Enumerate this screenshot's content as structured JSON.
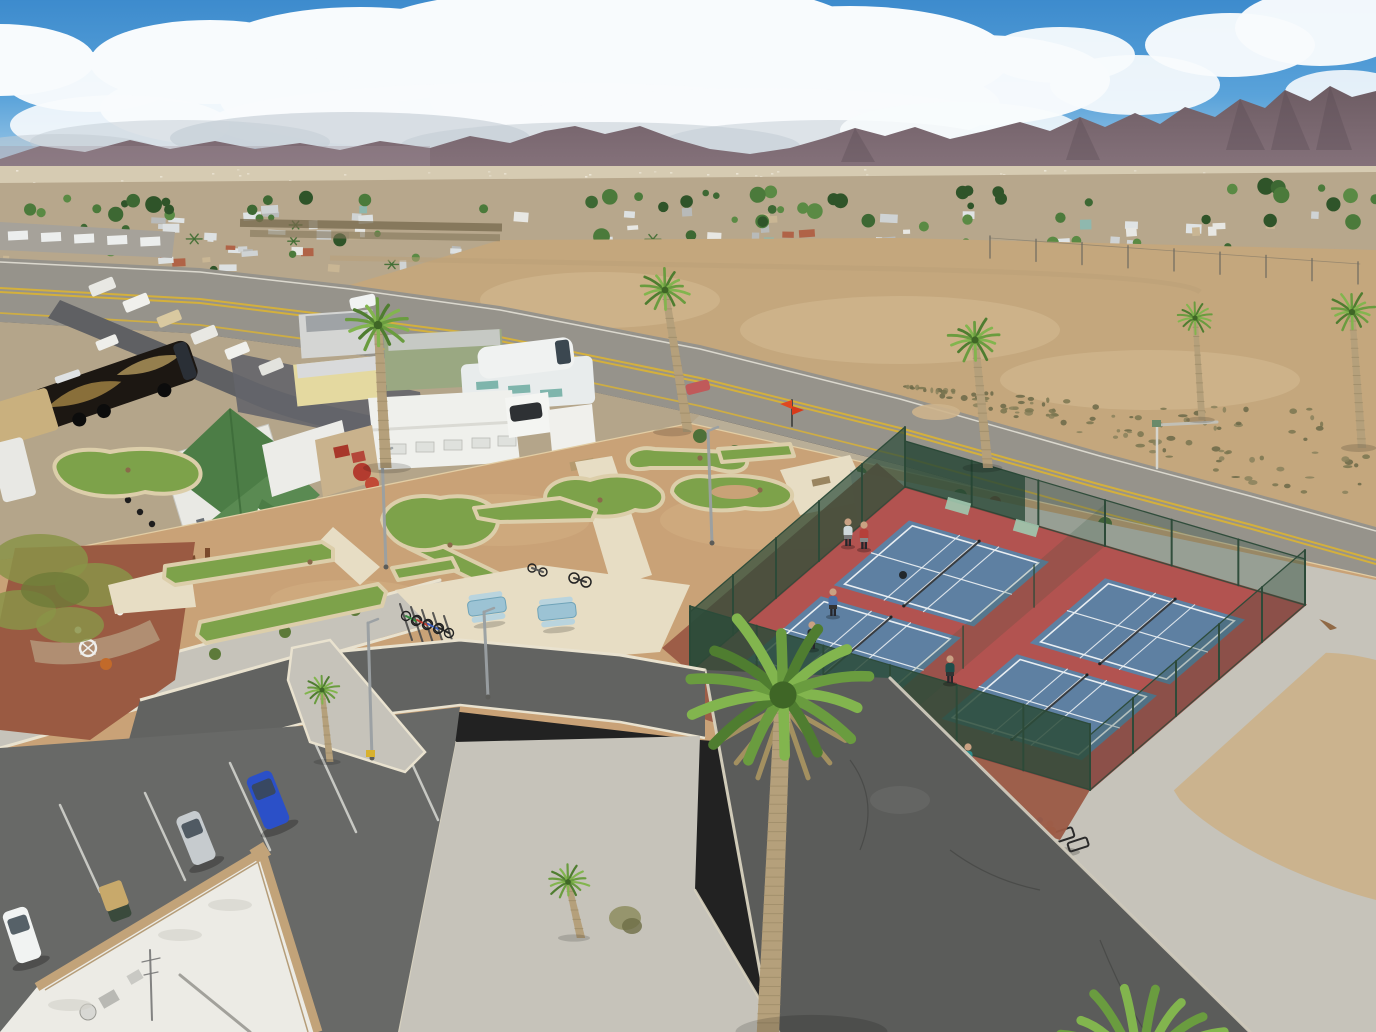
{
  "meta": {
    "type": "aerial-drone-photograph",
    "width": 1376,
    "height": 1032,
    "description": "Aerial view of a desert RV resort: mini-golf putting course and plaza behind a block wall, four fenced pickleball courts with players, curving asphalt drives, a parking lot with cars and a golf cart, white rooftop in the foreground corner, palm trees, a highway with double yellow lines, a dirt field, a distant mobile-home town, mountain range and cumulus clouds."
  },
  "palette": {
    "sky_top": "#3d8bcd",
    "sky_horizon": "#a9cfe9",
    "cloud_white": "#f8fbfd",
    "cloud_shadow": "#c2ccd4",
    "mountain": "#6d5c63",
    "mountain_haze": "#a3929a",
    "distant_strip": "#d6cbb2",
    "town_base": "#b7a78c",
    "field_tan": "#c4a77d",
    "highway_asphalt": "#96938b",
    "yellow_line": "#d4b03c",
    "rv_ground": "#b4a58a",
    "street_asphalt": "#5f6063",
    "wall_tan": "#c9ab80",
    "wall_shadow": "#a8885d",
    "resort_tan": "#c9a277",
    "granite_red": "#9a5a42",
    "gravel": "#c6c3ba",
    "concrete": "#e7ddc4",
    "turf": "#7da24a",
    "turf_dark": "#5f8539",
    "turf_edge": "#dcceaa",
    "court_red": "#b25350",
    "court_blue": "#5e80a2",
    "court_line": "#e9eef2",
    "fence_green": "#2c4a38",
    "loop_road": "#626361",
    "parking_asphalt": "#686967",
    "main_road": "#5b5c5a",
    "curb": "#ddd6c2",
    "roof_white": "#ecebe5",
    "parapet_tan": "#c2a379",
    "palm_frond": "#6a9c3f",
    "palm_frond_light": "#82b54e",
    "palm_trunk": "#b5a07b",
    "motorcoach_black": "#1c1712",
    "motorcoach_gold": "#96793f",
    "car_blue": "#2b50c8",
    "car_silver": "#c6cbce",
    "car_white": "#f1f3f2",
    "golf_cart_tan": "#c8a96b",
    "cottage_roof_green": "#4c7d46",
    "skin": "#c9a183"
  },
  "counts": {
    "pickleball_courts": 4,
    "pickleball_players": 6,
    "spectators_at_top_court": 2,
    "bench_sitters": 1,
    "mini_golf_holes": 11,
    "picnic_tables": 2,
    "parked_cars": 3,
    "golf_carts": 1,
    "light_poles": 4,
    "foreground_palms": 2
  },
  "generated": {
    "seed": 7,
    "town_houses": 170,
    "town_trees": 90,
    "town_palms": 12,
    "strip_specks": 60,
    "field_scrub": 120
  }
}
